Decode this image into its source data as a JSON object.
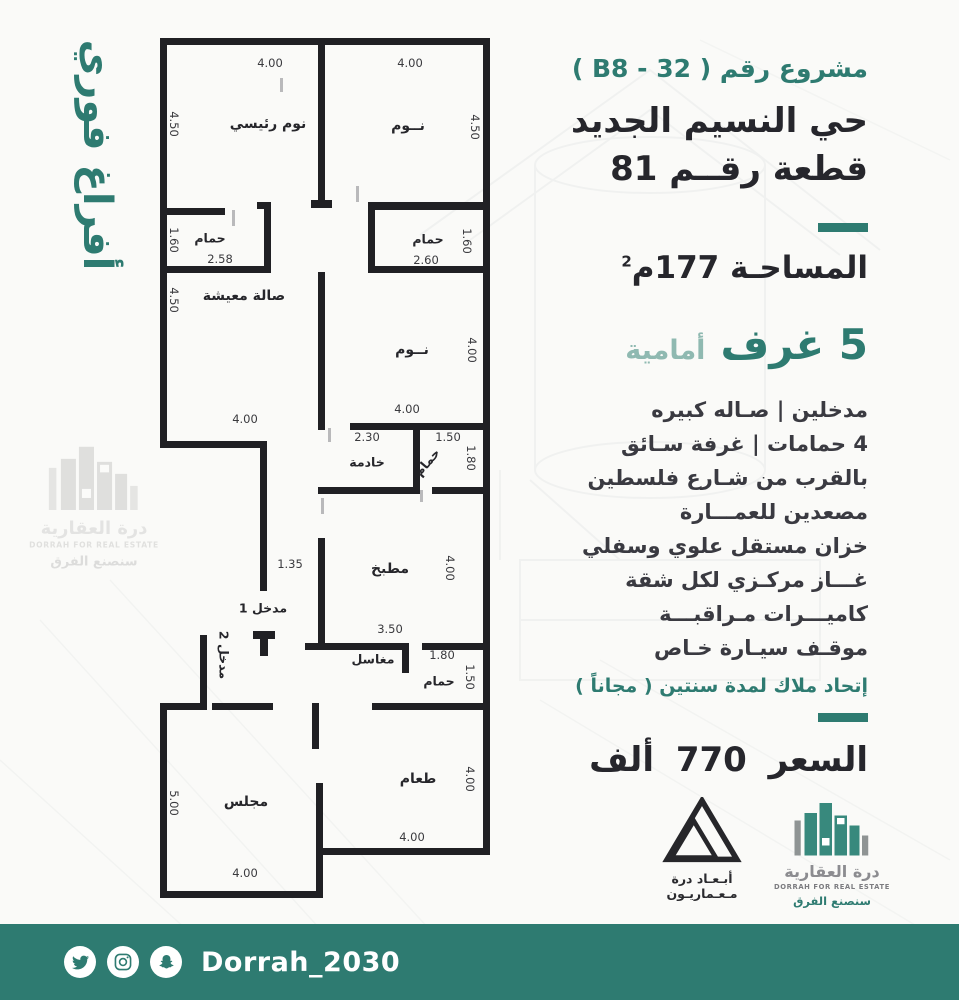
{
  "colors": {
    "teal": "#2e7b71",
    "teal_light": "#8fb9b1",
    "ink": "#26262c",
    "wall": "#202024",
    "footer_bg": "#2e7b71"
  },
  "side_banner": {
    "text": "أفراغ فوري"
  },
  "header": {
    "project_line": "مشروع رقم ( B8 - 32 )",
    "district": "حي النسيم الجديد",
    "plot": "قطعة رقــم 81"
  },
  "area": {
    "label": "المساحـة 177م",
    "sup": "2"
  },
  "rooms_line": {
    "count_text": "5 غرف",
    "suffix": "أمامية"
  },
  "features": [
    "مدخلين   |   صـاله كبيره",
    "4 حمامات | غرفة سـائق",
    "بالقرب من شـارع فلسطين",
    "مصعدين    للعمـــارة",
    "خزان مستقل علوي وسفلي",
    "غـــاز مركـزي لكل شقة",
    "كاميـــرات مـراقبـــة",
    "موقـف سيـارة خـاص"
  ],
  "owners_union": "إتحاد ملاك لمدة سنتين ( مجاناً )",
  "price": "السعر 770 ألف",
  "floorplan": {
    "labels": [
      {
        "text": "نوم رئيسي",
        "x": 108,
        "y": 86,
        "cls": "room"
      },
      {
        "text": "نــوم",
        "x": 248,
        "y": 88,
        "cls": "room"
      },
      {
        "text": "حمام",
        "x": 50,
        "y": 200,
        "cls": "room sm"
      },
      {
        "text": "حمام",
        "x": 268,
        "y": 201,
        "cls": "room sm"
      },
      {
        "text": "صالة معيشة",
        "x": 84,
        "y": 258,
        "cls": "room"
      },
      {
        "text": "نــوم",
        "x": 252,
        "y": 312,
        "cls": "room"
      },
      {
        "text": "خادمة",
        "x": 207,
        "y": 424,
        "cls": "room sm"
      },
      {
        "text": "حمام",
        "x": 267,
        "y": 424,
        "rot": -50,
        "cls": "room sm"
      },
      {
        "text": "مطبخ",
        "x": 230,
        "y": 531,
        "cls": "room"
      },
      {
        "text": "مدخل 1",
        "x": 103,
        "y": 570,
        "cls": "room sm"
      },
      {
        "text": "مدخل 2",
        "x": 64,
        "y": 617,
        "rot": 90,
        "cls": "room sm"
      },
      {
        "text": "مغاسل",
        "x": 213,
        "y": 621,
        "cls": "room sm"
      },
      {
        "text": "حمام",
        "x": 279,
        "y": 643,
        "cls": "room sm"
      },
      {
        "text": "مجلس",
        "x": 86,
        "y": 764,
        "cls": "room"
      },
      {
        "text": "طعام",
        "x": 258,
        "y": 741,
        "cls": "room"
      },
      {
        "text": "4.00",
        "x": 110,
        "y": 25,
        "cls": "dim"
      },
      {
        "text": "4.00",
        "x": 250,
        "y": 25,
        "cls": "dim"
      },
      {
        "text": "4.50",
        "x": 14,
        "y": 86,
        "rot": 90,
        "cls": "dim"
      },
      {
        "text": "4.50",
        "x": 315,
        "y": 89,
        "rot": 90,
        "cls": "dim"
      },
      {
        "text": "1.60",
        "x": 14,
        "y": 202,
        "rot": 90,
        "cls": "dim"
      },
      {
        "text": "2.58",
        "x": 60,
        "y": 221,
        "cls": "dim"
      },
      {
        "text": "1.60",
        "x": 307,
        "y": 203,
        "rot": 90,
        "cls": "dim"
      },
      {
        "text": "2.60",
        "x": 266,
        "y": 222,
        "cls": "dim"
      },
      {
        "text": "4.50",
        "x": 14,
        "y": 262,
        "rot": 90,
        "cls": "dim"
      },
      {
        "text": "4.00",
        "x": 85,
        "y": 381,
        "cls": "dim"
      },
      {
        "text": "4.00",
        "x": 312,
        "y": 312,
        "rot": 90,
        "cls": "dim"
      },
      {
        "text": "4.00",
        "x": 247,
        "y": 371,
        "cls": "dim"
      },
      {
        "text": "2.30",
        "x": 207,
        "y": 399,
        "cls": "dim"
      },
      {
        "text": "1.50",
        "x": 288,
        "y": 399,
        "cls": "dim"
      },
      {
        "text": "1.80",
        "x": 311,
        "y": 420,
        "rot": 90,
        "cls": "dim"
      },
      {
        "text": "1.35",
        "x": 130,
        "y": 526,
        "cls": "dim"
      },
      {
        "text": "4.00",
        "x": 290,
        "y": 530,
        "rot": 90,
        "cls": "dim"
      },
      {
        "text": "3.50",
        "x": 230,
        "y": 591,
        "cls": "dim"
      },
      {
        "text": "1.80",
        "x": 282,
        "y": 617,
        "cls": "dim"
      },
      {
        "text": "1.50",
        "x": 310,
        "y": 639,
        "rot": 90,
        "cls": "dim"
      },
      {
        "text": "5.00",
        "x": 14,
        "y": 765,
        "rot": 90,
        "cls": "dim"
      },
      {
        "text": "4.00",
        "x": 85,
        "y": 835,
        "cls": "dim"
      },
      {
        "text": "4.00",
        "x": 310,
        "y": 741,
        "rot": 90,
        "cls": "dim"
      },
      {
        "text": "4.00",
        "x": 252,
        "y": 799,
        "cls": "dim"
      }
    ]
  },
  "logos": {
    "abaad": {
      "line1": "أبـعـاد درة",
      "line2": "مـعـماريـون"
    },
    "dorrah": {
      "name": "درة العقارية",
      "en": "DORRAH FOR REAL ESTATE",
      "slogan": "سنصنع الفرق"
    }
  },
  "footer": {
    "handle": "Dorrah_2030",
    "icons": [
      "twitter-icon",
      "instagram-icon",
      "snapchat-icon"
    ]
  }
}
